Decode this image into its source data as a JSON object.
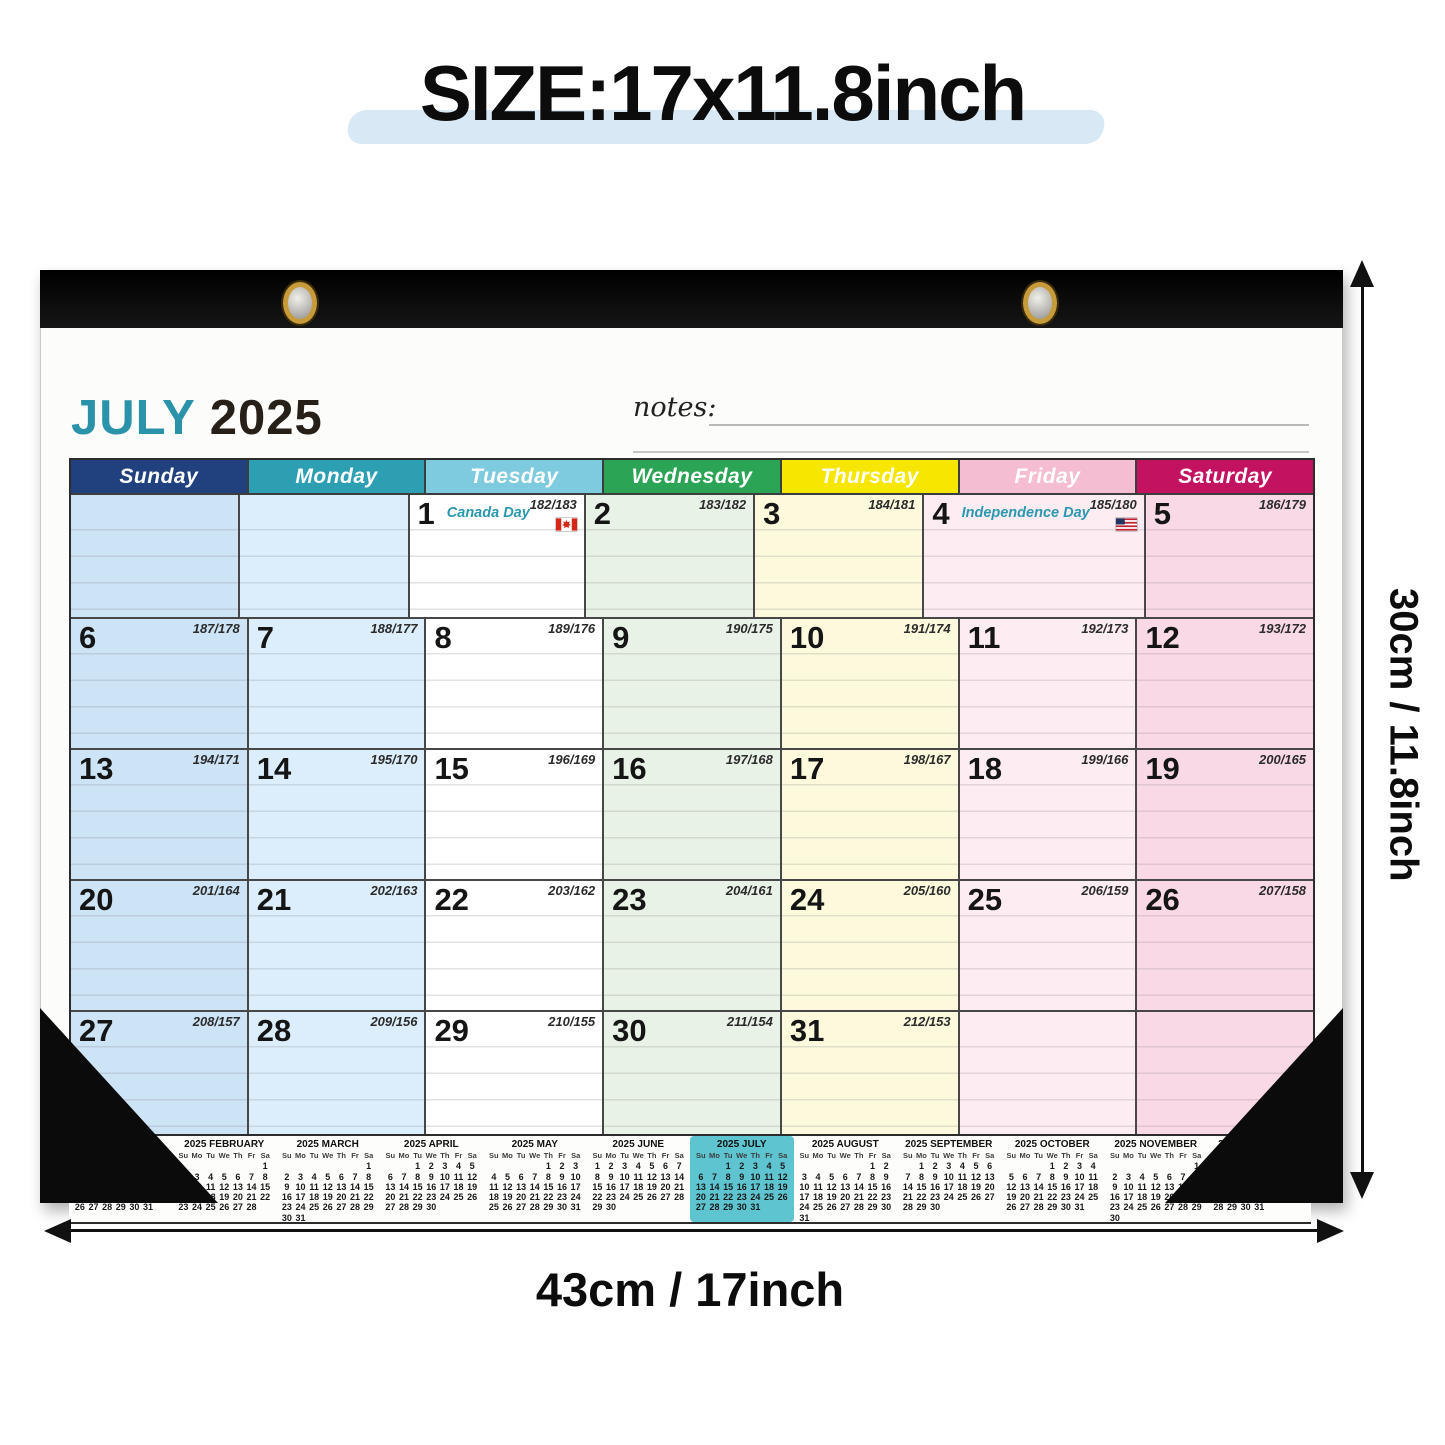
{
  "title": {
    "text": "SIZE:17x11.8inch"
  },
  "dimensions": {
    "height_label": "30cm / 11.8inch",
    "width_label": "43cm / 17inch"
  },
  "calendar": {
    "month_label": "JULY",
    "year_label": "2025",
    "notes_label": "notes:",
    "day_headers": [
      {
        "label": "Sunday",
        "header_color": "#21417e",
        "cell_color": "#cde4f6"
      },
      {
        "label": "Monday",
        "header_color": "#2d9fb2",
        "cell_color": "#dceefb"
      },
      {
        "label": "Tuesday",
        "header_color": "#7ecadf",
        "cell_color": "#ffffff"
      },
      {
        "label": "Wednesday",
        "header_color": "#2ca455",
        "cell_color": "#e9f2e6"
      },
      {
        "label": "Thursday",
        "header_color": "#f6e600",
        "cell_color": "#fcf9dc"
      },
      {
        "label": "Friday",
        "header_color": "#f4bdd1",
        "cell_color": "#fdedf3"
      },
      {
        "label": "Saturday",
        "header_color": "#c3125f",
        "cell_color": "#f9d9e6"
      }
    ],
    "weeks": [
      [
        {
          "day": "",
          "yearday": ""
        },
        {
          "day": "",
          "yearday": ""
        },
        {
          "day": "1",
          "yearday": "182/183",
          "holiday": "Canada Day",
          "flag": "canada"
        },
        {
          "day": "2",
          "yearday": "183/182"
        },
        {
          "day": "3",
          "yearday": "184/181"
        },
        {
          "day": "4",
          "yearday": "185/180",
          "holiday": "Independence Day",
          "flag": "us"
        },
        {
          "day": "5",
          "yearday": "186/179"
        }
      ],
      [
        {
          "day": "6",
          "yearday": "187/178"
        },
        {
          "day": "7",
          "yearday": "188/177"
        },
        {
          "day": "8",
          "yearday": "189/176"
        },
        {
          "day": "9",
          "yearday": "190/175"
        },
        {
          "day": "10",
          "yearday": "191/174"
        },
        {
          "day": "11",
          "yearday": "192/173"
        },
        {
          "day": "12",
          "yearday": "193/172"
        }
      ],
      [
        {
          "day": "13",
          "yearday": "194/171"
        },
        {
          "day": "14",
          "yearday": "195/170"
        },
        {
          "day": "15",
          "yearday": "196/169"
        },
        {
          "day": "16",
          "yearday": "197/168"
        },
        {
          "day": "17",
          "yearday": "198/167"
        },
        {
          "day": "18",
          "yearday": "199/166"
        },
        {
          "day": "19",
          "yearday": "200/165"
        }
      ],
      [
        {
          "day": "20",
          "yearday": "201/164"
        },
        {
          "day": "21",
          "yearday": "202/163"
        },
        {
          "day": "22",
          "yearday": "203/162"
        },
        {
          "day": "23",
          "yearday": "204/161"
        },
        {
          "day": "24",
          "yearday": "205/160"
        },
        {
          "day": "25",
          "yearday": "206/159"
        },
        {
          "day": "26",
          "yearday": "207/158"
        }
      ],
      [
        {
          "day": "27",
          "yearday": "208/157"
        },
        {
          "day": "28",
          "yearday": "209/156"
        },
        {
          "day": "29",
          "yearday": "210/155"
        },
        {
          "day": "30",
          "yearday": "211/154"
        },
        {
          "day": "31",
          "yearday": "212/153"
        },
        {
          "day": "",
          "yearday": ""
        },
        {
          "day": "",
          "yearday": ""
        }
      ]
    ]
  },
  "mini_calendars": {
    "weekday_header": [
      "Su",
      "Mo",
      "Tu",
      "We",
      "Th",
      "Fr",
      "Sa"
    ],
    "highlight_color": "#5ec5d0",
    "months": [
      {
        "title": "2025 JANUARY",
        "highlight": false,
        "weeks": [
          [
            "",
            "",
            "",
            "1",
            "2",
            "3",
            "4"
          ],
          [
            "5",
            "6",
            "7",
            "8",
            "9",
            "10",
            "11"
          ],
          [
            "12",
            "13",
            "14",
            "15",
            "16",
            "17",
            "18"
          ],
          [
            "19",
            "20",
            "21",
            "22",
            "23",
            "24",
            "25"
          ],
          [
            "26",
            "27",
            "28",
            "29",
            "30",
            "31",
            ""
          ]
        ]
      },
      {
        "title": "2025 FEBRUARY",
        "highlight": false,
        "weeks": [
          [
            "",
            "",
            "",
            "",
            "",
            "",
            "1"
          ],
          [
            "2",
            "3",
            "4",
            "5",
            "6",
            "7",
            "8"
          ],
          [
            "9",
            "10",
            "11",
            "12",
            "13",
            "14",
            "15"
          ],
          [
            "16",
            "17",
            "18",
            "19",
            "20",
            "21",
            "22"
          ],
          [
            "23",
            "24",
            "25",
            "26",
            "27",
            "28",
            ""
          ]
        ]
      },
      {
        "title": "2025 MARCH",
        "highlight": false,
        "weeks": [
          [
            "",
            "",
            "",
            "",
            "",
            "",
            "1"
          ],
          [
            "2",
            "3",
            "4",
            "5",
            "6",
            "7",
            "8"
          ],
          [
            "9",
            "10",
            "11",
            "12",
            "13",
            "14",
            "15"
          ],
          [
            "16",
            "17",
            "18",
            "19",
            "20",
            "21",
            "22"
          ],
          [
            "23",
            "24",
            "25",
            "26",
            "27",
            "28",
            "29"
          ],
          [
            "30",
            "31",
            "",
            "",
            "",
            "",
            ""
          ]
        ]
      },
      {
        "title": "2025 APRIL",
        "highlight": false,
        "weeks": [
          [
            "",
            "",
            "1",
            "2",
            "3",
            "4",
            "5"
          ],
          [
            "6",
            "7",
            "8",
            "9",
            "10",
            "11",
            "12"
          ],
          [
            "13",
            "14",
            "15",
            "16",
            "17",
            "18",
            "19"
          ],
          [
            "20",
            "21",
            "22",
            "23",
            "24",
            "25",
            "26"
          ],
          [
            "27",
            "28",
            "29",
            "30",
            "",
            "",
            ""
          ]
        ]
      },
      {
        "title": "2025 MAY",
        "highlight": false,
        "weeks": [
          [
            "",
            "",
            "",
            "",
            "1",
            "2",
            "3"
          ],
          [
            "4",
            "5",
            "6",
            "7",
            "8",
            "9",
            "10"
          ],
          [
            "11",
            "12",
            "13",
            "14",
            "15",
            "16",
            "17"
          ],
          [
            "18",
            "19",
            "20",
            "21",
            "22",
            "23",
            "24"
          ],
          [
            "25",
            "26",
            "27",
            "28",
            "29",
            "30",
            "31"
          ]
        ]
      },
      {
        "title": "2025 JUNE",
        "highlight": false,
        "weeks": [
          [
            "1",
            "2",
            "3",
            "4",
            "5",
            "6",
            "7"
          ],
          [
            "8",
            "9",
            "10",
            "11",
            "12",
            "13",
            "14"
          ],
          [
            "15",
            "16",
            "17",
            "18",
            "19",
            "20",
            "21"
          ],
          [
            "22",
            "23",
            "24",
            "25",
            "26",
            "27",
            "28"
          ],
          [
            "29",
            "30",
            "",
            "",
            "",
            "",
            ""
          ]
        ]
      },
      {
        "title": "2025 JULY",
        "highlight": true,
        "weeks": [
          [
            "",
            "",
            "1",
            "2",
            "3",
            "4",
            "5"
          ],
          [
            "6",
            "7",
            "8",
            "9",
            "10",
            "11",
            "12"
          ],
          [
            "13",
            "14",
            "15",
            "16",
            "17",
            "18",
            "19"
          ],
          [
            "20",
            "21",
            "22",
            "23",
            "24",
            "25",
            "26"
          ],
          [
            "27",
            "28",
            "29",
            "30",
            "31",
            "",
            ""
          ]
        ]
      },
      {
        "title": "2025 AUGUST",
        "highlight": false,
        "weeks": [
          [
            "",
            "",
            "",
            "",
            "",
            "1",
            "2"
          ],
          [
            "3",
            "4",
            "5",
            "6",
            "7",
            "8",
            "9"
          ],
          [
            "10",
            "11",
            "12",
            "13",
            "14",
            "15",
            "16"
          ],
          [
            "17",
            "18",
            "19",
            "20",
            "21",
            "22",
            "23"
          ],
          [
            "24",
            "25",
            "26",
            "27",
            "28",
            "29",
            "30"
          ],
          [
            "31",
            "",
            "",
            "",
            "",
            "",
            ""
          ]
        ]
      },
      {
        "title": "2025 SEPTEMBER",
        "highlight": false,
        "weeks": [
          [
            "",
            "1",
            "2",
            "3",
            "4",
            "5",
            "6"
          ],
          [
            "7",
            "8",
            "9",
            "10",
            "11",
            "12",
            "13"
          ],
          [
            "14",
            "15",
            "16",
            "17",
            "18",
            "19",
            "20"
          ],
          [
            "21",
            "22",
            "23",
            "24",
            "25",
            "26",
            "27"
          ],
          [
            "28",
            "29",
            "30",
            "",
            "",
            "",
            ""
          ]
        ]
      },
      {
        "title": "2025 OCTOBER",
        "highlight": false,
        "weeks": [
          [
            "",
            "",
            "",
            "1",
            "2",
            "3",
            "4"
          ],
          [
            "5",
            "6",
            "7",
            "8",
            "9",
            "10",
            "11"
          ],
          [
            "12",
            "13",
            "14",
            "15",
            "16",
            "17",
            "18"
          ],
          [
            "19",
            "20",
            "21",
            "22",
            "23",
            "24",
            "25"
          ],
          [
            "26",
            "27",
            "28",
            "29",
            "30",
            "31",
            ""
          ]
        ]
      },
      {
        "title": "2025 NOVEMBER",
        "highlight": false,
        "weeks": [
          [
            "",
            "",
            "",
            "",
            "",
            "",
            "1"
          ],
          [
            "2",
            "3",
            "4",
            "5",
            "6",
            "7",
            "8"
          ],
          [
            "9",
            "10",
            "11",
            "12",
            "13",
            "14",
            "15"
          ],
          [
            "16",
            "17",
            "18",
            "19",
            "20",
            "21",
            "22"
          ],
          [
            "23",
            "24",
            "25",
            "26",
            "27",
            "28",
            "29"
          ],
          [
            "30",
            "",
            "",
            "",
            "",
            "",
            ""
          ]
        ]
      },
      {
        "title": "2025 DECEMBER",
        "highlight": false,
        "weeks": [
          [
            "",
            "1",
            "2",
            "3",
            "4",
            "5",
            "6"
          ],
          [
            "7",
            "8",
            "9",
            "10",
            "11",
            "12",
            "13"
          ],
          [
            "14",
            "15",
            "16",
            "17",
            "18",
            "19",
            "20"
          ],
          [
            "21",
            "22",
            "23",
            "24",
            "25",
            "26",
            "27"
          ],
          [
            "28",
            "29",
            "30",
            "31",
            "",
            "",
            ""
          ]
        ]
      }
    ]
  }
}
